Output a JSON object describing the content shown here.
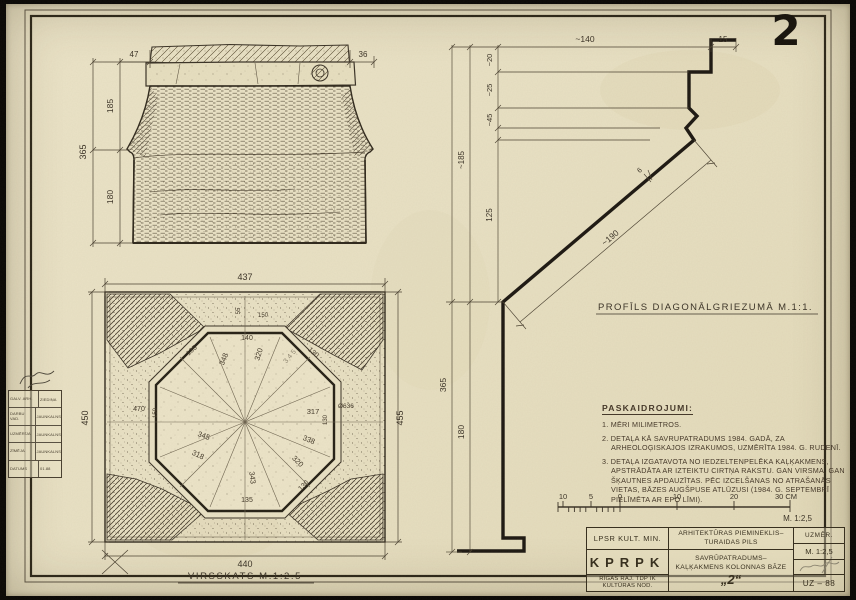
{
  "sheet": {
    "number": "2"
  },
  "elevation": {
    "dim_overhang_left": "47",
    "dim_overhang_right": "36",
    "dim_upper": "185",
    "dim_lower": "180",
    "dim_total": "365"
  },
  "plan": {
    "title": "VIRSSKATS  M.1:2.5",
    "dim_top": "437",
    "dim_bottom": "440",
    "dim_left": "450",
    "dim_right": "455",
    "dim_rim": "55",
    "dim_rim2": "150",
    "edge_top": "140",
    "edge_upper_left": "135",
    "edge_upper_right": "130",
    "edge_right": "Ø636",
    "edge_right_small": "130",
    "edge_lower_right": "130",
    "edge_bottom": "135",
    "dim_left_inner": "470",
    "dim_left_inner2": "150",
    "rays": [
      "320",
      "348",
      "345",
      "317",
      "338",
      "320",
      "343",
      "345",
      "318"
    ]
  },
  "profile": {
    "title": "PROFĪLS DIAGONĀLGRIEZUMĀ M.1:1.",
    "dim_top": "~140",
    "dim_top_right": "15",
    "chain": [
      "~20",
      "~25",
      "~45",
      "125"
    ],
    "dim_left_upper": "~185",
    "dim_left_lower": "180",
    "dim_total": "365",
    "dim_diagonal": "~190",
    "dim_thickness": "6"
  },
  "notes": {
    "heading": "PASKAIDROJUMI:",
    "items": [
      "1. MĒRI MILIMETROS.",
      "2. DETAĻA KĀ SAVRUPATRADUMS 1984. GADĀ, ZA ARHEOLOĢISKAJOS IZRAKUMOS, UZMĒRĪTA 1984. G. RUDENĪ.",
      "3. DETAĻA IZGATAVOTA NO IEDZELTENPELĒKA KAĻĶAKMENS, APSTRĀDĀTA AR IZTEIKTU CIRTŅA RAKSTU. GAN VIRSMA, GAN ŠĶAUTNES APDAUZĪTAS. PĒC IZCELŠANAS NO ATRAŠANĀS VIETAS, BĀZES AUGŠPUSE ATLŪZUSI (1984. G. SEPTEMBRĪ PIELĪMĒTA AR EPO LĪMI)."
    ]
  },
  "scalebar": {
    "labels": [
      "10",
      "5",
      "0",
      "10",
      "20",
      "30 CM"
    ],
    "scale": "M. 1:2,5"
  },
  "titleblock": {
    "org_line1": "LPSR  KULT. MIN.",
    "org_code": "KPRPK",
    "org_line3a": "RĪGAS RAJ. TDP IK",
    "org_line3b": "KULTŪRAS NOD.",
    "monument_line1": "ARHITEKTŪRAS PIEMINEKLIS–",
    "monument_line2": "TURAIDAS PILS",
    "subject_line1": "SAVRŪPATRADUMS–",
    "subject_line2": "KAĻĶAKMENS KOLONNAS BĀZE",
    "subject_number": "„2“",
    "measured_label": "UZMĒR.",
    "scale": "M. 1:2,5",
    "sheet_code": "UZ – 88"
  },
  "stamp": {
    "rows": [
      {
        "label": "GALV. ARH.",
        "value": "ZIEDIŅA"
      },
      {
        "label": "DARBU VAD.",
        "value": "JAUNKALNS"
      },
      {
        "label": "UZMĒRĪJA",
        "value": "JAUNKALNS"
      },
      {
        "label": "ZĪMĒJA",
        "value": "JAUNKALNS"
      },
      {
        "label": "DATUMS",
        "value": "01.88"
      }
    ]
  }
}
